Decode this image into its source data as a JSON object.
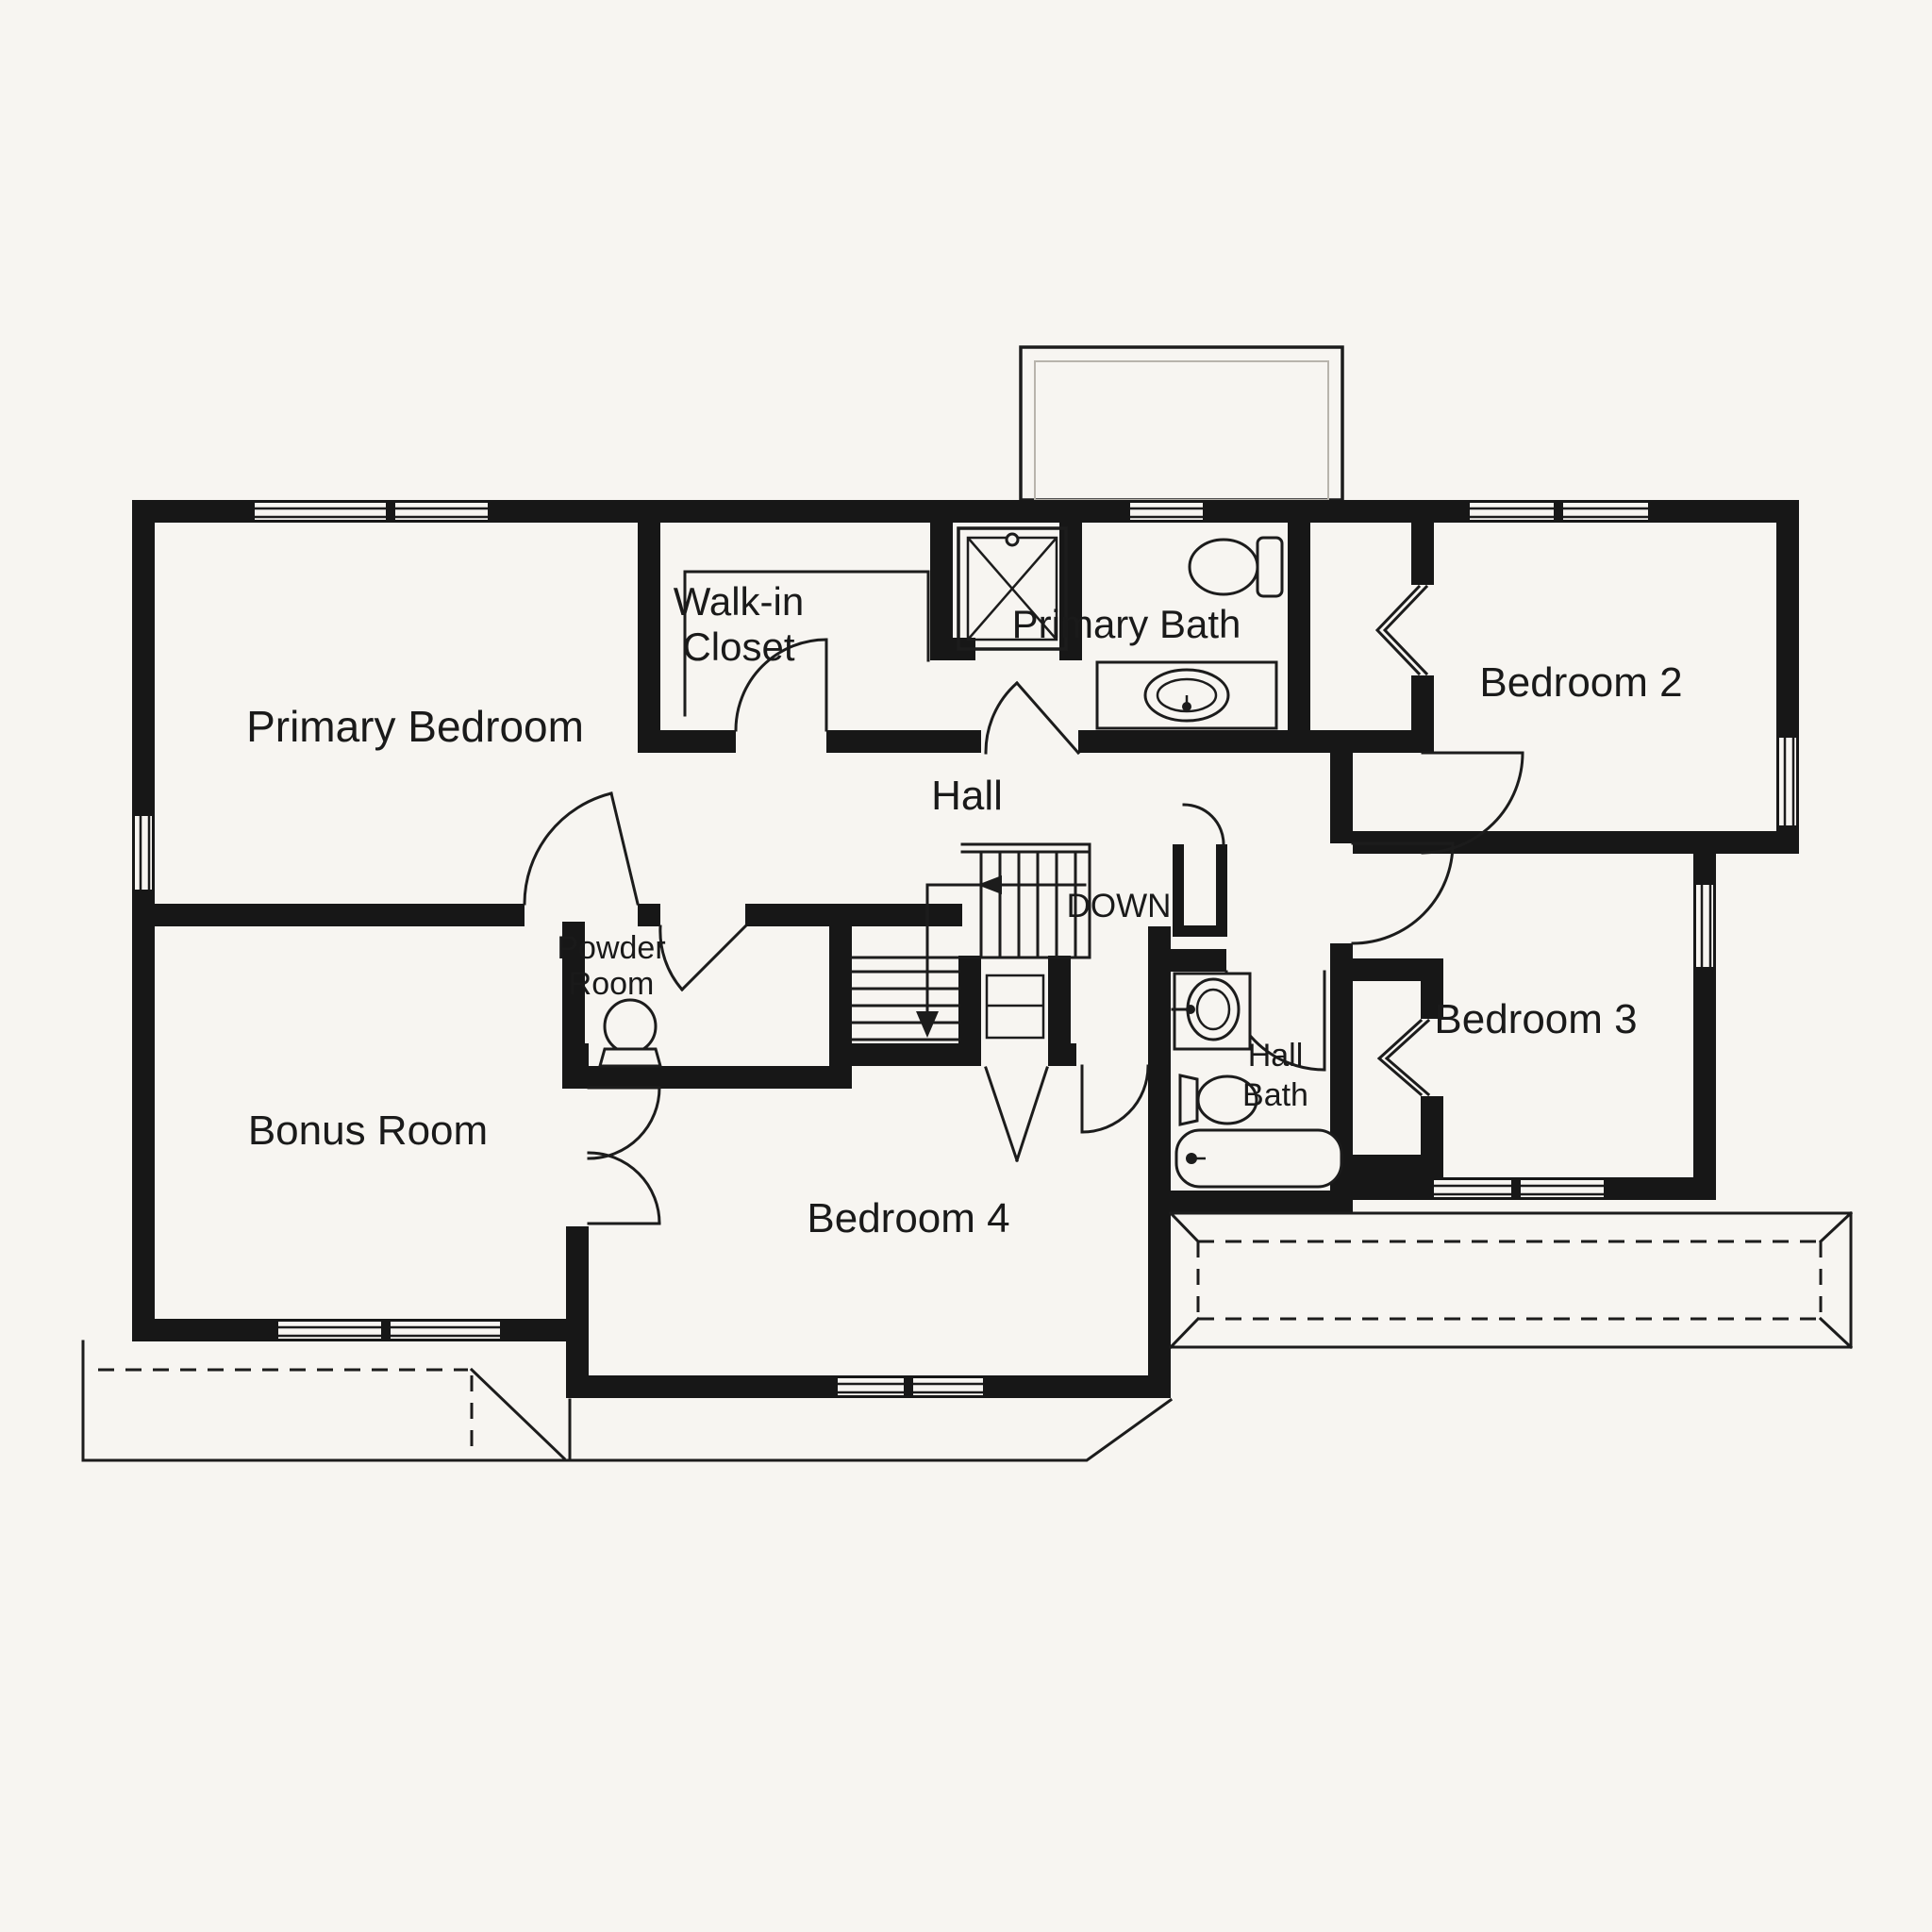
{
  "colors": {
    "background": "#f7f5f1",
    "wall": "#171717",
    "line": "#1c1c1c",
    "label": "#1a1a1a",
    "faint": "#b8b4ac"
  },
  "labels": {
    "primary_bedroom": "Primary Bedroom",
    "walk_in_closet_line1": "Walk-in",
    "walk_in_closet_line2": "Closet",
    "primary_bath": "Primary Bath",
    "bedroom_2": "Bedroom 2",
    "hall": "Hall",
    "down": "DOWN",
    "powder_room_line1": "Powder",
    "powder_room_line2": "Room",
    "bonus_room": "Bonus Room",
    "bedroom_4": "Bedroom 4",
    "hall_bath_line1": "Hall",
    "hall_bath_line2": "Bath",
    "bedroom_3": "Bedroom 3"
  }
}
